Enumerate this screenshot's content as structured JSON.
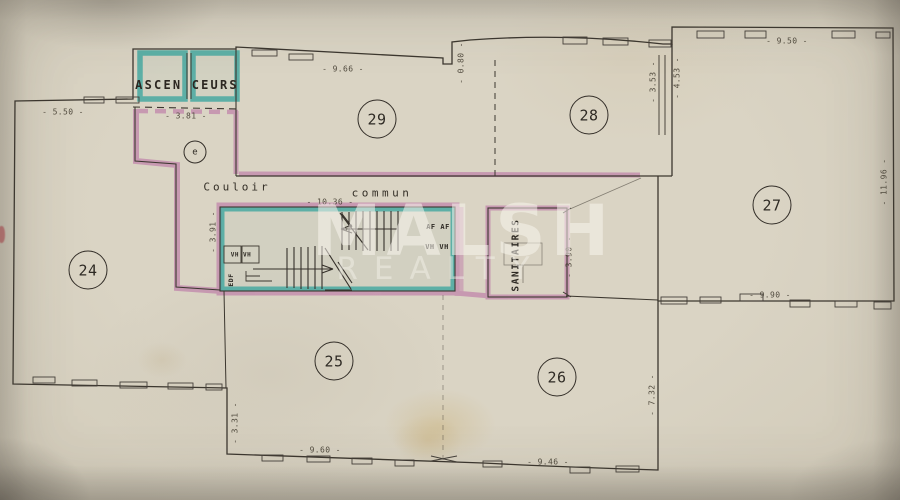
{
  "watermark": {
    "line1": "MALSH",
    "line2": "REALTY"
  },
  "plan": {
    "rooms": [
      {
        "number": "24"
      },
      {
        "number": "25"
      },
      {
        "number": "26"
      },
      {
        "number": "27"
      },
      {
        "number": "28"
      },
      {
        "number": "29"
      }
    ],
    "entrance_label": "e",
    "labels": {
      "elevators": "ASCEN CEURS",
      "corridor_word1": "Couloir",
      "corridor_word2": "commun",
      "sanitary": "SANITAIRES",
      "utility_edf": "EDF",
      "vents_left": "VH VH",
      "vents_af": "AF AF",
      "vents_vh": "VH VH"
    },
    "dimensions": {
      "w550": "- 5.50 -",
      "w381": "- 3.81 -",
      "w966": "- 9.66 -",
      "h080": "- 0.80 -",
      "w950": "- 9.50 -",
      "h353": "- 3.53 -",
      "h453": "- 4.53 -",
      "h1196": "- 11.96 -",
      "w990": "- 9.90 -",
      "h732": "- 7.32 -",
      "w946": "- 9.46 -",
      "w960": "- 9.60 -",
      "h331": "- 3.31 -",
      "w1036": "- 10.36 -",
      "h390": "- 3.90 -",
      "h391": "- 3.91 -"
    }
  },
  "colors": {
    "ink": "#3c372f",
    "highlight_teal": "#3aa59e",
    "highlight_pink": "#b560a0",
    "paper": "#d5cebc"
  }
}
